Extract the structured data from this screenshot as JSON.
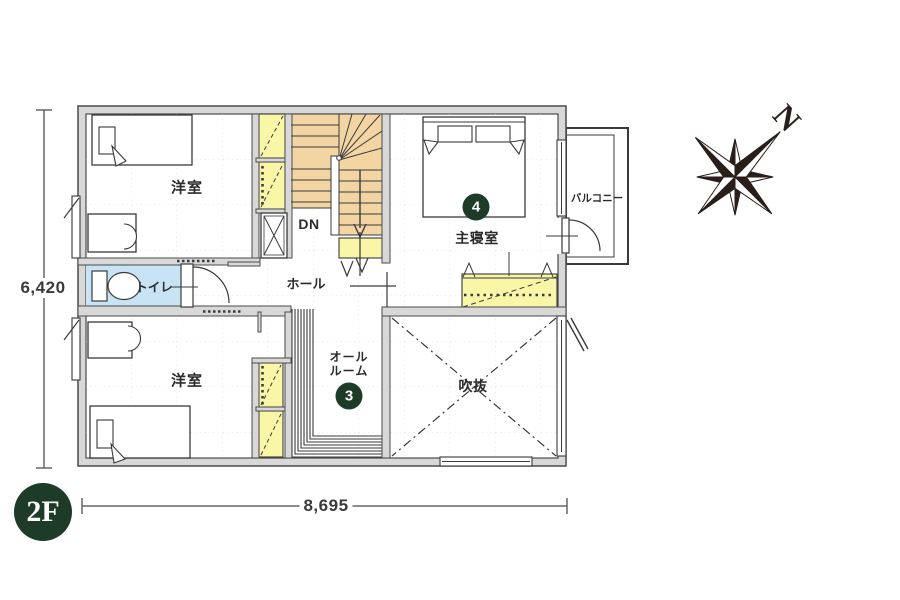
{
  "floor": {
    "badge": "2F"
  },
  "compass": {
    "north": "N"
  },
  "dimensions": {
    "left": "6,420",
    "bottom": "8,695"
  },
  "rooms": {
    "bedroom_top": {
      "label": "洋室"
    },
    "bedroom_bottom": {
      "label": "洋室"
    },
    "toilet": {
      "label": "トイレ"
    },
    "hall": {
      "label": "ホール"
    },
    "stairs": {
      "label": "DN"
    },
    "master_bedroom": {
      "label": "主寝室",
      "number": "4"
    },
    "balcony": {
      "label": "バルコニー"
    },
    "all_room": {
      "label_line1": "オール",
      "label_line2": "ルーム",
      "number": "3"
    },
    "void": {
      "label": "吹抜"
    }
  },
  "colors": {
    "accent_green": "#1e3b28",
    "stairs_fill": "#f3d5a4",
    "closet_fill": "#faf6a8",
    "toilet_fill": "#c8e3f4",
    "wall_fill": "#d8d8d8",
    "line": "#3a3a3a"
  }
}
